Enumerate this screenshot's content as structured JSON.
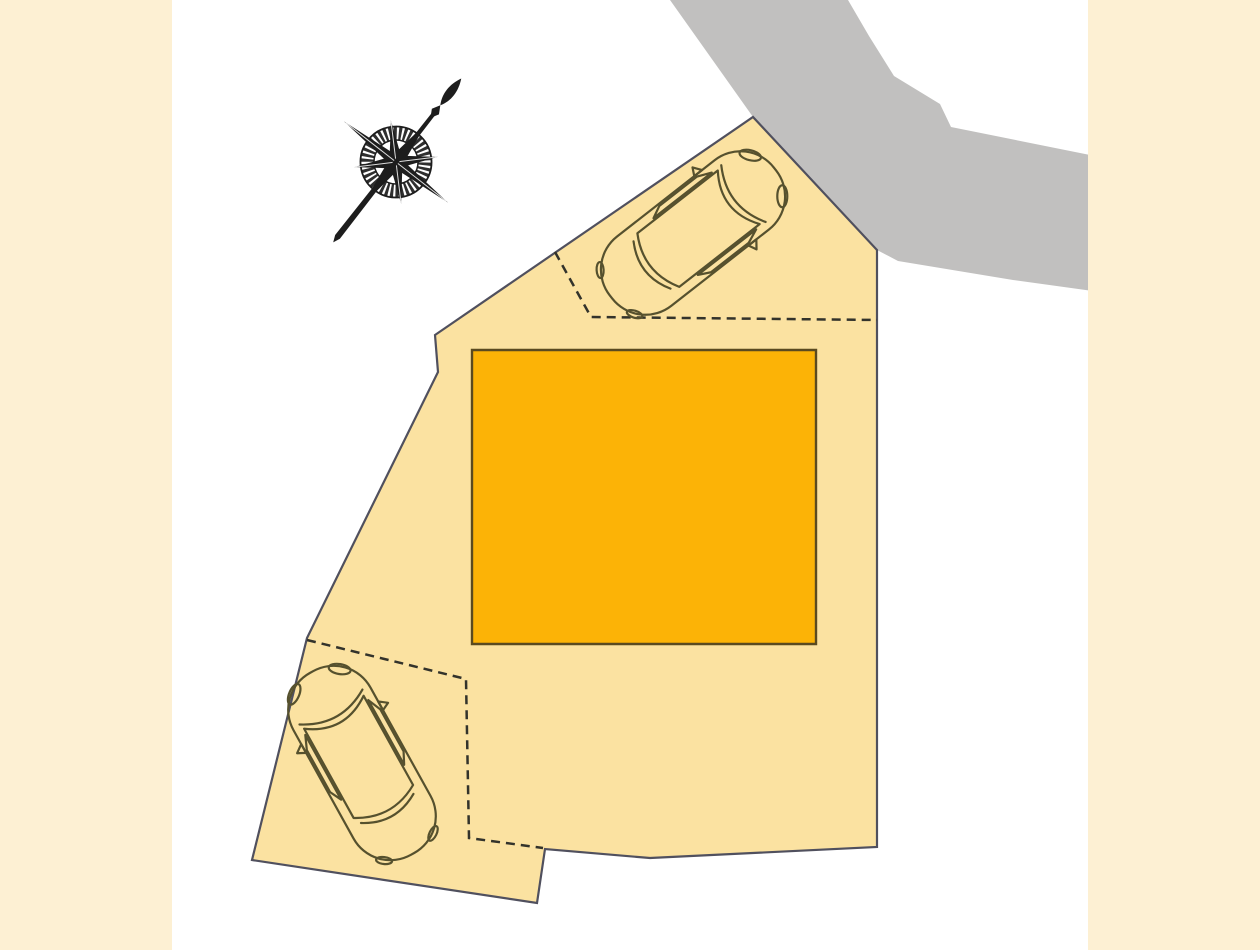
{
  "meta": {
    "description": "Residential lot site plan with building footprint, two parking bays with cars, adjoining road and compass rose pointing north-east"
  },
  "colors": {
    "background": "#ffffff",
    "margin_panels": "#fdf0d3",
    "road_fill": "#c1c0bf",
    "plot_fill": "#fbe2a1",
    "plot_border": "#50505e",
    "building_fill": "#fcb306",
    "building_border": "#5a4a20",
    "dashed_line": "#33332b",
    "car_outline": "#56512e",
    "compass_ink": "#1d1d1d"
  },
  "site_plan": {
    "road": {
      "points": "670,0 848,0 869,36 894,76 940,104 951,127 1100,157 1100,292 1013,280 898,261 877,250 753,117"
    },
    "plot": {
      "points": "753,117 877,250 877,847 650,858 545,849 537,903 252,860 307,638 438,372 435,335"
    },
    "building": {
      "points": "472,350 816,350 816,644 472,644"
    },
    "parking_boundaries": [
      {
        "points": "555,252 591,317 877,320"
      },
      {
        "points": "307,640 466,679 469,838 543,848"
      }
    ],
    "cars": [
      {
        "transform": "translate(693,233) rotate(52)"
      },
      {
        "transform": "translate(362,763) rotate(-29)"
      }
    ],
    "compass": {
      "transform": "translate(396,162) rotate(38)"
    }
  }
}
